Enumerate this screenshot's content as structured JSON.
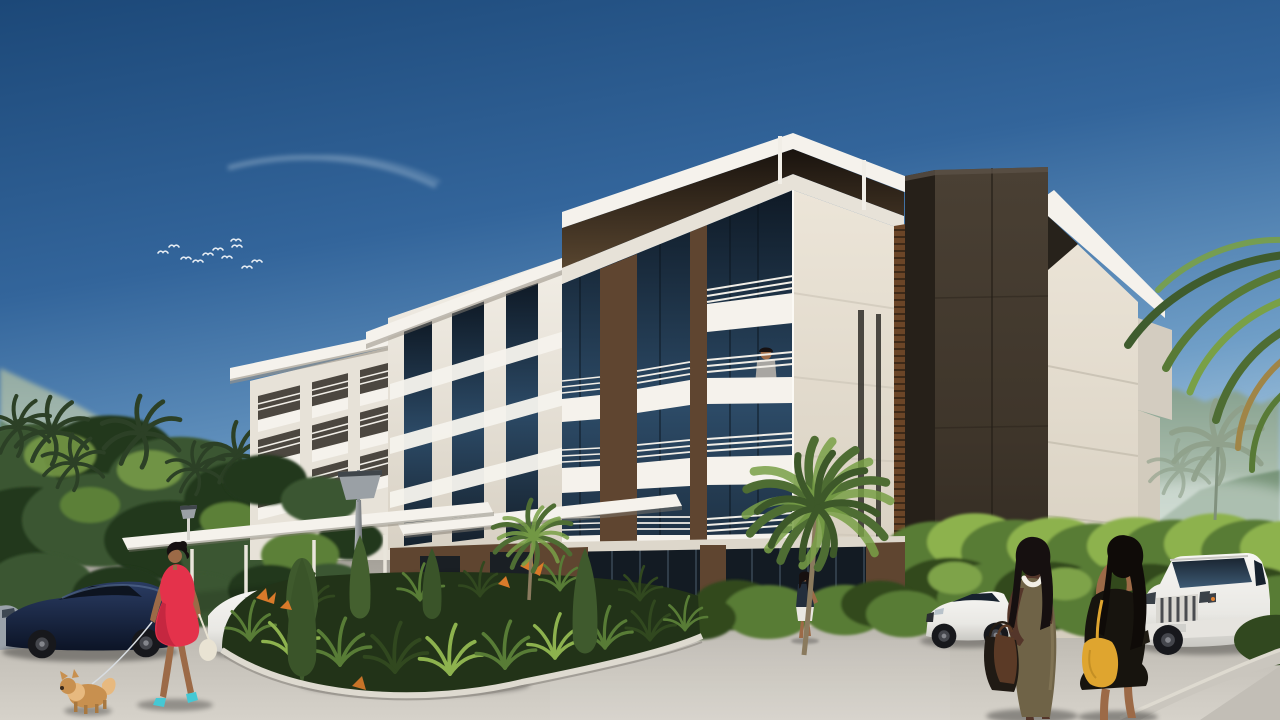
{
  "scene": {
    "title": "Sunlit architectural rendering of a modern hillside apartment complex with parking forecourt",
    "sky": "clear blue sky with a faint contrail and a small flock of white birds upper left",
    "landscape": [
      "hazy green mountains left and right",
      "tropical trees with palm crowns",
      "landscaped island with ornamental grasses, conical cypresses and orange bird-of-paradise flowers"
    ],
    "lighting": {
      "time": "midday",
      "sun_direction": "upper left"
    }
  },
  "building": {
    "style": "contemporary flat-roof stacked volumes, five storeys",
    "materials": [
      "white stucco",
      "cream stucco",
      "dark bronze cladding tower",
      "wood slat panels",
      "dark tinted glass"
    ],
    "features": [
      "deep cantilevered roof slabs",
      "stacked balconies with white horizontal-bar railings",
      "rooftop terrace with thin posts",
      "entrance porte-cochere with slim columns",
      "ground-floor glass storefront",
      "modern cone-head street lamp"
    ]
  },
  "vehicles": [
    {
      "type": "sedan",
      "color": "dark navy",
      "position": "far left, side view"
    },
    {
      "type": "sedan",
      "color": "white",
      "position": "behind woman in red dress"
    },
    {
      "type": "sedan",
      "color": "white",
      "position": "center, three-quarter view facing left, behind planted island"
    },
    {
      "type": "sedan",
      "color": "white BMW-style",
      "position": "right middle distance, side view facing left"
    },
    {
      "type": "suv",
      "color": "white Land-Cruiser-style",
      "position": "far right, front three-quarter view"
    }
  ],
  "people": [
    {
      "description": "woman in short red dress with teal heels walking a small tan dog on a leash, cream handbag",
      "position": "left foreground"
    },
    {
      "description": "man in gray t-shirt standing at a balcony railing",
      "position": "center tower upper balcony"
    },
    {
      "description": "woman in dark top and white skirt walking",
      "position": "near ground-floor storefront beside palm"
    },
    {
      "description": "dark-skinned woman in fitted olive midi dress with chunky white necklace carrying brown and black bags",
      "position": "right foreground"
    },
    {
      "description": "long-haired woman in black outfit with yellow shoulder bag holding up a phone to take a photo",
      "position": "right foreground"
    }
  ],
  "animals": [
    {
      "type": "dog",
      "look": "small fluffy tan pomeranian",
      "position": "left foreground on leash"
    }
  ],
  "colors": {
    "sky-top": "#1c4878",
    "sky-mid": "#33659b",
    "sky-low": "#6f9ec7",
    "sky-horizon": "#c6dcea",
    "contrail": "#dce9f2",
    "mtn-far": "#93aba3",
    "mtn-far2": "#c7d4c8",
    "mtn-near": "#5f8266",
    "mist": "#e8f0ef",
    "tree-dark": "#24371d",
    "tree-mid": "#3a5631",
    "tree-light": "#5c8038",
    "tree-hi": "#7ea34a",
    "palm-sil": "#2c4026",
    "bush-bright": "#8db24e",
    "bush-mid": "#587c36",
    "bush-dark": "#31481f",
    "bldg-white": "#f5f2ec",
    "bldg-white2": "#e7e2d8",
    "bldg-shade": "#d3ccc0",
    "bldg-cream": "#e9e2d4",
    "soffit1": "#19130e",
    "soffit2": "#58452f",
    "wood": "#5f4530",
    "wood-dark": "#3c2b1c",
    "dark-tower": "#3e352a",
    "dark-tower-side": "#262019",
    "glass-top": "#0f1a26",
    "glass-mid": "#2c4a66",
    "glass-low": "#16222e",
    "rail": "#f1eee7",
    "pave-far": "#a09c94",
    "pave-mid": "#bcb8b0",
    "pave-near": "#d4d0c8",
    "curb": "#dedad0",
    "curb-face": "#cac6be",
    "curb-shade": "#908c84",
    "store-glass": "#131b23",
    "store-mullion": "#34414e",
    "fence": "#2b251d",
    "car-navy": "#2a3c63",
    "car-navy-dark": "#0c1426",
    "car-white": "#f4f3f0",
    "car-white-shade": "#c9c8c3",
    "car-glass": "#17222e",
    "wheel": "#17181c",
    "hub": "#6a6c70",
    "skin": "#9c6a47",
    "skin-dark": "#54362a",
    "hair-dark": "#161010",
    "shirt-gray": "#a8a6a2",
    "dress-red": "#e4324b",
    "dress-red-dark": "#b02039",
    "dress-olive": "#6f6347",
    "outfit-black": "#17140e",
    "skirt-white": "#e9e7e1",
    "top-navy": "#232e3c",
    "bag-yellow": "#dfa52f",
    "bag-cream": "#e9e3d3",
    "bag-brown": "#5b3a26",
    "bag-black": "#201a14",
    "dog-tan": "#c8904f",
    "dog-tan-hi": "#e7b97f",
    "dog-leg": "#a87840",
    "heel-teal": "#45c8d4",
    "lamp-metal": "#9aa0a5",
    "trunk": "#8a7a5e",
    "palm-green": "#4e6d33",
    "palm-green-hi": "#79a047",
    "palm-gray": "#8fa08a",
    "palm-brown": "#a08547",
    "leash": "#d8dde2",
    "necklace-white": "#f2efe6",
    "gold": "#d8b050",
    "signal-orange": "#e08030",
    "headlight": "#c3ced6",
    "grille-dark": "#2f3339",
    "plate": "#d0d0cc"
  }
}
